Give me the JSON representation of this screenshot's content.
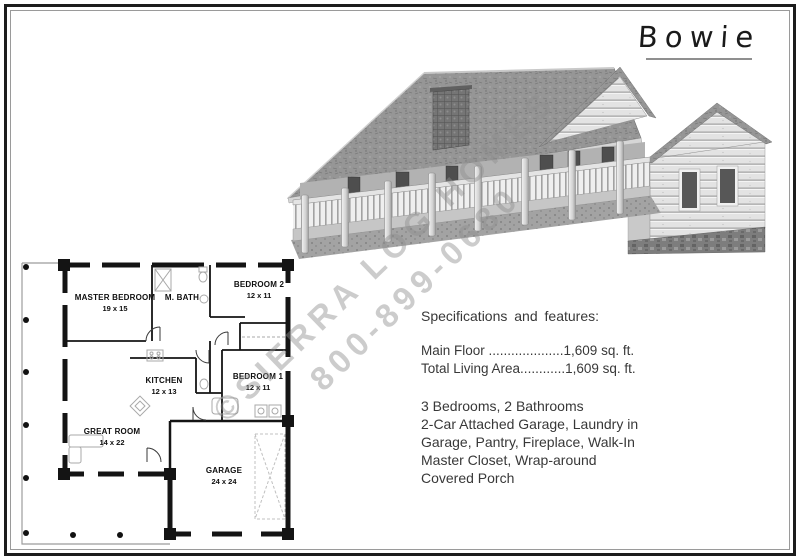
{
  "page": {
    "title": "Bowie"
  },
  "watermark": {
    "line1": "©SIERRA LOG HOMES",
    "line2": "800-899-0680"
  },
  "specs": {
    "heading": "Specifications and features:",
    "area_lines": [
      "Main Floor ....................1,609 sq. ft.",
      "Total Living Area............1,609 sq. ft."
    ],
    "feature_lines": [
      "3 Bedrooms, 2 Bathrooms",
      "2-Car Attached Garage, Laundry in",
      "Garage, Pantry, Fireplace, Walk-In",
      "Master Closet, Wrap-around",
      "Covered Porch"
    ]
  },
  "floor_plan": {
    "rooms": [
      {
        "name": "MASTER BEDROOM",
        "size": "19 x 15"
      },
      {
        "name": "M. BATH",
        "size": ""
      },
      {
        "name": "BEDROOM 2",
        "size": "12 x 11"
      },
      {
        "name": "KITCHEN",
        "size": "12 x 13"
      },
      {
        "name": "BEDROOM 1",
        "size": "12 x 11"
      },
      {
        "name": "GREAT ROOM",
        "size": "14 x 22"
      },
      {
        "name": "GARAGE",
        "size": "24 x 24"
      }
    ]
  }
}
